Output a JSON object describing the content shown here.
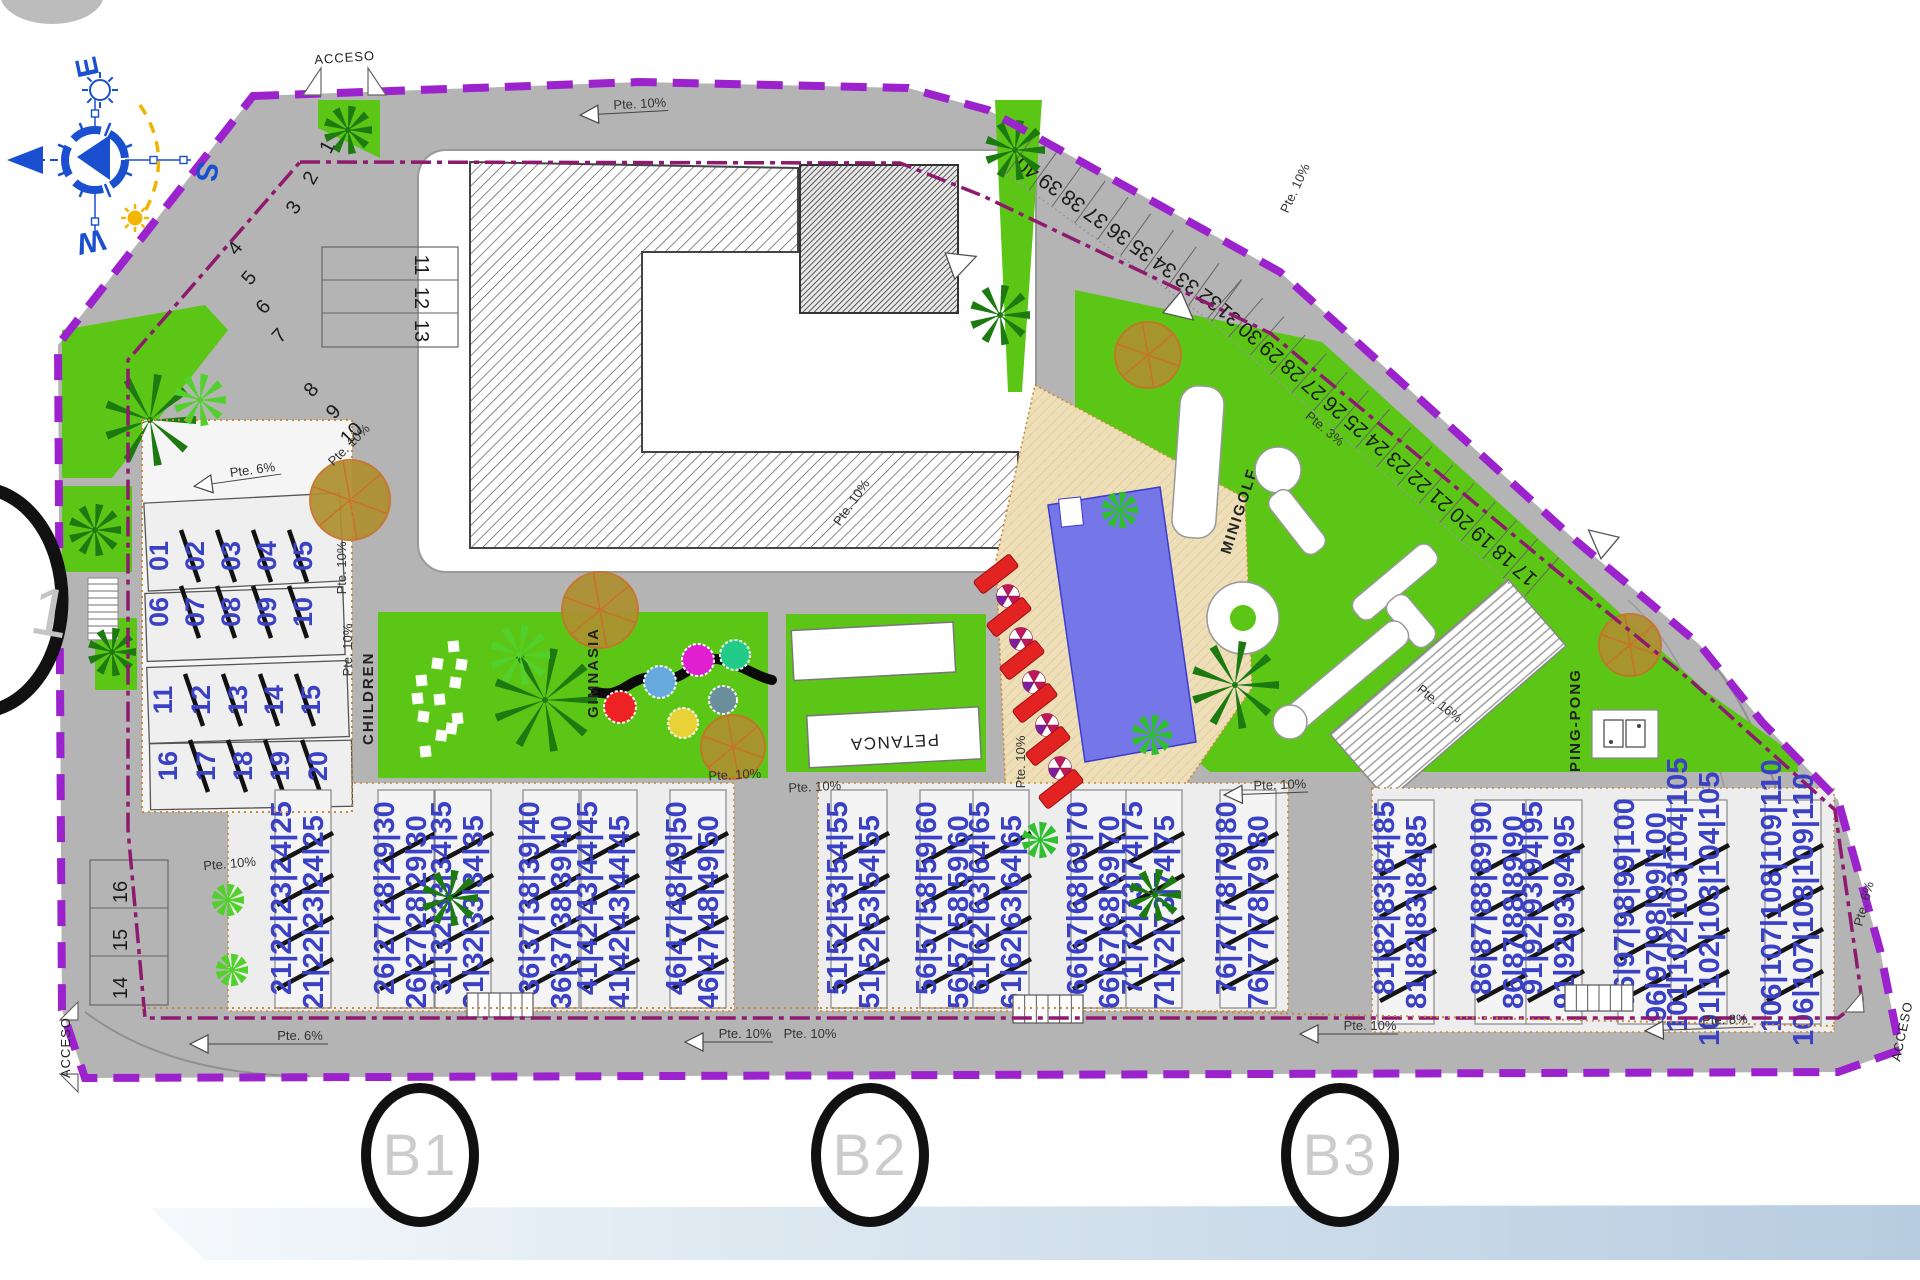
{
  "compass": {
    "e": "E",
    "s": "S",
    "w": "W"
  },
  "access_labels": [
    "ACCESO",
    "ACCESO",
    "ACCESO"
  ],
  "area_labels": {
    "children": "CHILDREN",
    "gimnasia": "GIMNASIA",
    "petanca": "PETANCA",
    "minigolf": "MINIGOLF",
    "pingpong": "PING-PONG"
  },
  "slope_labels": [
    "Pte. 10%",
    "Pte. 6%",
    "Pte. 10%",
    "Pte. 10%",
    "Pte. 10%",
    "Pte. 10%",
    "Pte. 6%",
    "Pte. 10%",
    "Pte. 10%",
    "Pte. 10%",
    "Pte. 8%",
    "Pte. 6%",
    "Pte. 10%",
    "Pte. 10%",
    "Pte. 10%",
    "Pte. 10%",
    "Pte. 3%",
    "Pte. 16%",
    "Pte. 10%",
    "Pte. 10%"
  ],
  "parking": {
    "diagonal_row": [
      "40",
      "39",
      "38",
      "37",
      "36",
      "35",
      "34",
      "33",
      "32",
      "31",
      "30",
      "29",
      "28",
      "27",
      "26",
      "25",
      "24",
      "23",
      "22",
      "21",
      "20",
      "19",
      "18",
      "17"
    ],
    "upper_left": [
      "1",
      "2",
      "3",
      "4",
      "5",
      "6",
      "7",
      "8",
      "9",
      "10"
    ],
    "rack_top": [
      "11",
      "12",
      "13"
    ],
    "rack_left": [
      "16",
      "15",
      "14"
    ]
  },
  "plots": {
    "left_rows": [
      [
        "01",
        "02",
        "03",
        "04",
        "05"
      ],
      [
        "06",
        "07",
        "08",
        "09",
        "10"
      ],
      [
        "11",
        "12",
        "13",
        "14",
        "15"
      ],
      [
        "16",
        "17",
        "18",
        "19",
        "20"
      ]
    ],
    "bottom_blocks": [
      "21|22|23|24|25",
      "26|27|28|29|30",
      "31|32|33|34|35",
      "36|37|38|39|40",
      "41|42|43|44|45",
      "46|47|48|49|50",
      "51|52|53|54|55",
      "56|57|58|59|60",
      "61|62|63|64|65",
      "66|67|68|69|70",
      "71|72|73|74|75",
      "76|77|78|79|80",
      "81|82|83|84|85",
      "86|87|88|89|90",
      "91|92|93|94|95",
      "96|97|98|99|100",
      "101|102|103|104|105",
      "106|107|108|109|110"
    ]
  },
  "sections": [
    "B1",
    "B2",
    "B3"
  ],
  "edge_marker": "1",
  "colors": {
    "road": "#b4b4b4",
    "green": "#5cc616",
    "boundary_purple": "#9b22cc",
    "inner_line": "#8e1a70",
    "plot_number_blue": "#3a41c4",
    "pool_blue": "#7576e8",
    "deck_tan": "#eedfb8",
    "lounger_red": "#e32222",
    "orange_dots": "#cc8833",
    "bar_blue": "#bed2e4"
  }
}
